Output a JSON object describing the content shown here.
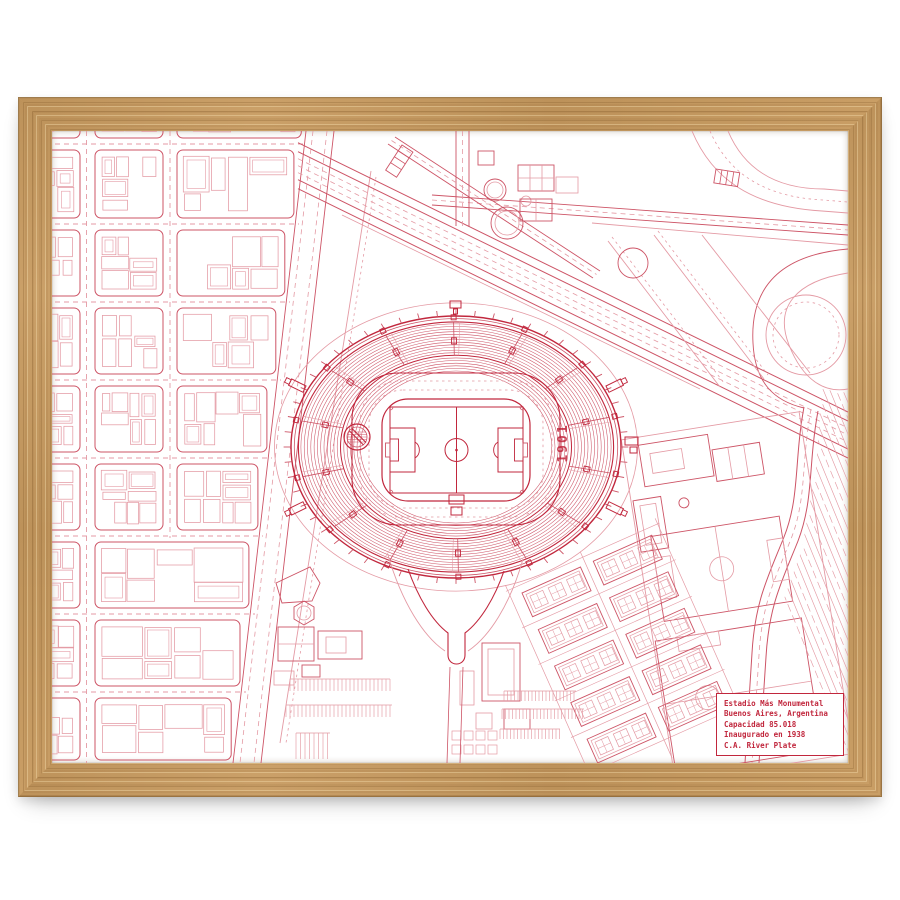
{
  "artwork": {
    "kind": "framed-stadium-blueprint-print",
    "stadium": {
      "year_label": "1901",
      "crest": "river-plate-crest"
    },
    "plate": {
      "lines": [
        "Estadio Más Monumental",
        "Buenos Aires, Argentina",
        "Capacidad 85.018",
        "Inaugurado en 1938",
        "C.A. River Plate"
      ]
    },
    "colors": {
      "ink": "#c1273d",
      "ink_mid": "#cd5466",
      "ink_soft": "#e49aa4",
      "paper": "#ffffff",
      "frame_wood": "#c79a5f",
      "frame_wood_dark": "#a87c46",
      "frame_wood_light": "#e3bd85"
    }
  }
}
